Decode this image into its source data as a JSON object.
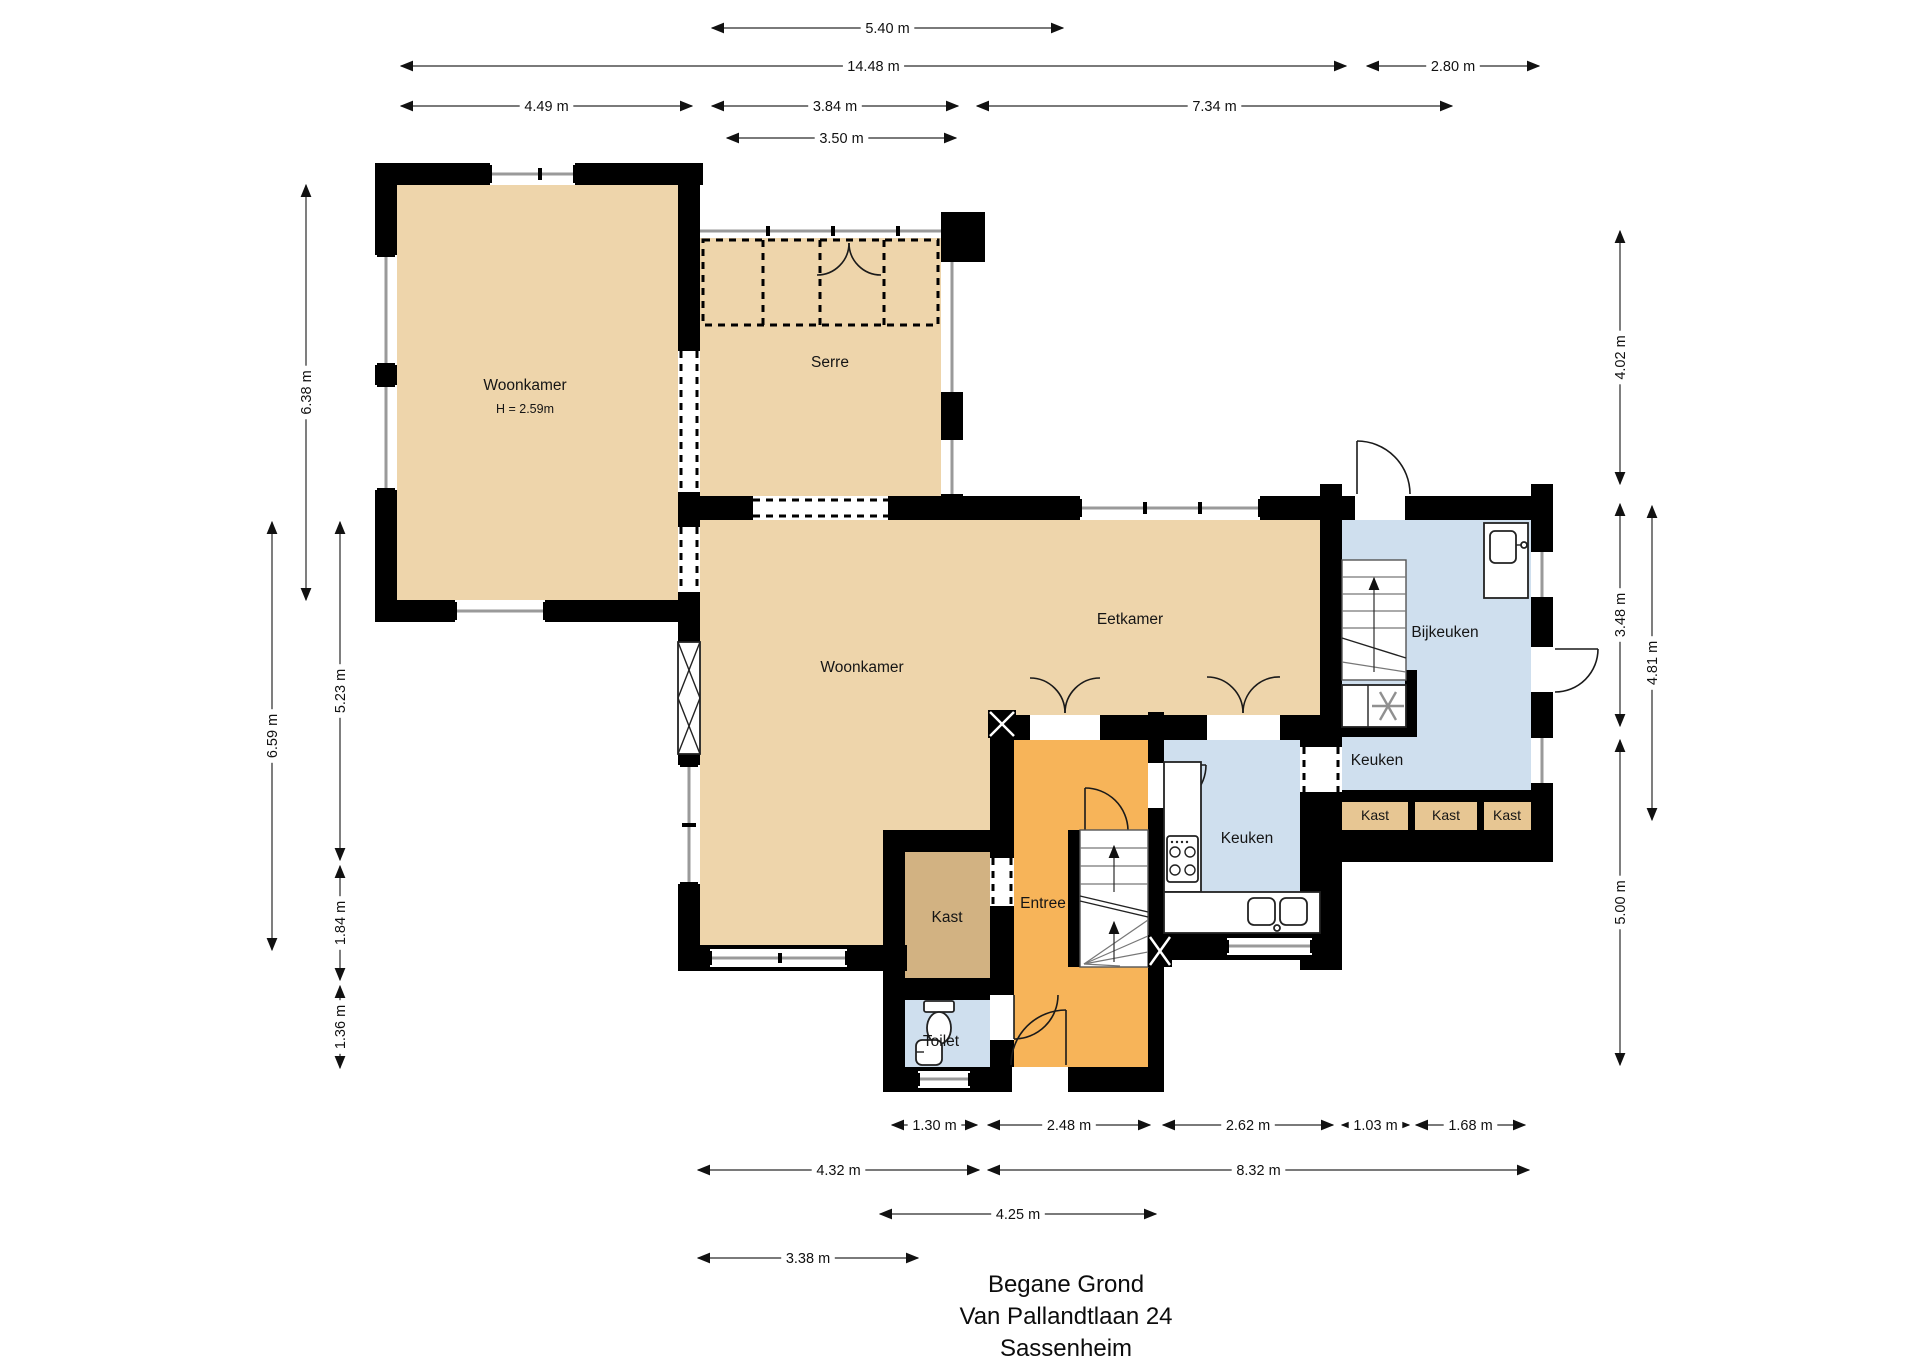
{
  "title": {
    "lines": [
      "Begane Grond",
      "Van Pallandtlaan 24",
      "Sassenheim"
    ]
  },
  "colors": {
    "floor_tan": "#eed5ab",
    "floor_orange": "#f7b459",
    "floor_blue": "#cfdfee",
    "floor_dark_tan": "#d2b282",
    "kast_cell_tan": "#e7c693",
    "wall": "#000000",
    "window_glass": "#9a9a9a",
    "dimension_text": "#111111"
  },
  "rooms": [
    {
      "id": "woonkamer-1",
      "label": "Woonkamer",
      "sublabel": "H = 2.59m",
      "x": 525,
      "y": 390,
      "sub_y": 413
    },
    {
      "id": "serre",
      "label": "Serre",
      "x": 830,
      "y": 367
    },
    {
      "id": "woonkamer-2",
      "label": "Woonkamer",
      "x": 862,
      "y": 672
    },
    {
      "id": "eetkamer",
      "label": "Eetkamer",
      "x": 1130,
      "y": 624
    },
    {
      "id": "bijkeuken",
      "label": "Bijkeuken",
      "x": 1445,
      "y": 637
    },
    {
      "id": "keuken-klein",
      "label": "Keuken",
      "x": 1377,
      "y": 765
    },
    {
      "id": "keuken",
      "label": "Keuken",
      "x": 1247,
      "y": 843
    },
    {
      "id": "entree",
      "label": "Entree",
      "x": 1043,
      "y": 908
    },
    {
      "id": "kast-entree",
      "label": "Kast",
      "x": 947,
      "y": 922
    },
    {
      "id": "toilet",
      "label": "Toilet",
      "x": 941,
      "y": 1046
    }
  ],
  "kast_cells": [
    {
      "label": "Kast",
      "x": 1375,
      "y": 820
    },
    {
      "label": "Kast",
      "x": 1446,
      "y": 820
    },
    {
      "label": "Kast",
      "x": 1507,
      "y": 820
    }
  ],
  "dimensions": {
    "top": [
      {
        "label": "5.40 m",
        "x1": 712,
        "x2": 1063,
        "y": 28
      },
      {
        "label": "14.48 m",
        "x1": 401,
        "x2": 1346,
        "y": 66
      },
      {
        "label": "2.80 m",
        "x1": 1367,
        "x2": 1539,
        "y": 66
      },
      {
        "label": "4.49 m",
        "x1": 401,
        "x2": 692,
        "y": 106
      },
      {
        "label": "3.84 m",
        "x1": 712,
        "x2": 958,
        "y": 106
      },
      {
        "label": "7.34 m",
        "x1": 977,
        "x2": 1452,
        "y": 106
      },
      {
        "label": "3.50 m",
        "x1": 727,
        "x2": 956,
        "y": 138
      }
    ],
    "left": [
      {
        "label": "6.38 m",
        "x": 306,
        "y1": 185,
        "y2": 600
      },
      {
        "label": "6.59 m",
        "x": 272,
        "y1": 522,
        "y2": 950
      },
      {
        "label": "5.23 m",
        "x": 340,
        "y1": 522,
        "y2": 860
      },
      {
        "label": "1.84 m",
        "x": 340,
        "y1": 866,
        "y2": 980
      },
      {
        "label": "1.36 m",
        "x": 340,
        "y1": 986,
        "y2": 1068
      }
    ],
    "right": [
      {
        "label": "4.02 m",
        "x": 1620,
        "y1": 231,
        "y2": 484
      },
      {
        "label": "3.48 m",
        "x": 1620,
        "y1": 504,
        "y2": 726
      },
      {
        "label": "4.81 m",
        "x": 1652,
        "y1": 506,
        "y2": 820
      },
      {
        "label": "5.00 m",
        "x": 1620,
        "y1": 740,
        "y2": 1065
      }
    ],
    "bottom": [
      {
        "label": "1.30 m",
        "x1": 892,
        "x2": 977,
        "y": 1125
      },
      {
        "label": "2.48 m",
        "x1": 988,
        "x2": 1150,
        "y": 1125
      },
      {
        "label": "2.62 m",
        "x1": 1163,
        "x2": 1333,
        "y": 1125
      },
      {
        "label": "1.03 m",
        "x1": 1342,
        "x2": 1409,
        "y": 1125
      },
      {
        "label": "1.68 m",
        "x1": 1416,
        "x2": 1525,
        "y": 1125
      },
      {
        "label": "4.32 m",
        "x1": 698,
        "x2": 979,
        "y": 1170
      },
      {
        "label": "8.32 m",
        "x1": 988,
        "x2": 1529,
        "y": 1170
      },
      {
        "label": "4.25 m",
        "x1": 880,
        "x2": 1156,
        "y": 1214
      },
      {
        "label": "3.38 m",
        "x1": 698,
        "x2": 918,
        "y": 1258
      }
    ]
  }
}
